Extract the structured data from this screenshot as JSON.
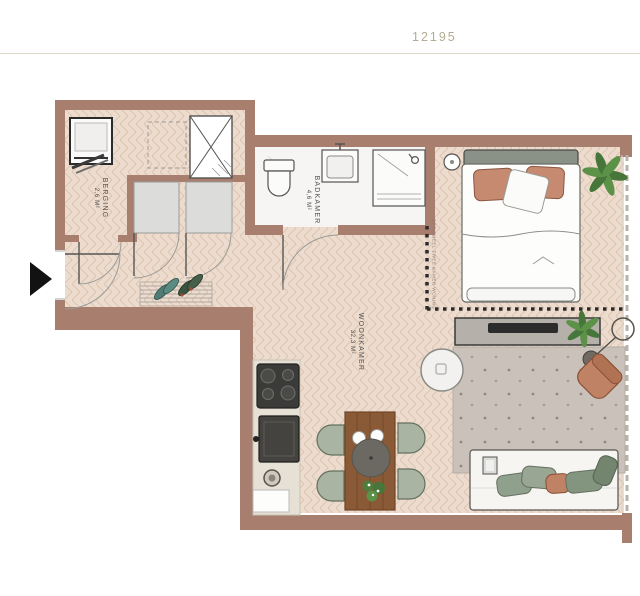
{
  "header": {
    "plan_number": "12195"
  },
  "plan": {
    "rooms": [
      {
        "name": "BERGING",
        "area": "2,6 M²"
      },
      {
        "name": "BADKAMER",
        "area": "4,6 M²"
      },
      {
        "name": "WOONKAMER",
        "area": "32,3 M²"
      }
    ],
    "annotation": {
      "optional_label": "OPTIONEEL TWEE KAMER WONING"
    },
    "colors": {
      "wall": "#a87e6e",
      "floor": "#eddccd",
      "floor_stroke": "#dcc5b2",
      "bathroom_floor": "#f6f5f3",
      "rug": "#cac2ba",
      "accent_terracotta": "#c08264",
      "accent_sage": "#a9b4a3",
      "plant_green": "#4e7d3e",
      "wood": "#8a5a36",
      "header_text": "#b3ab92",
      "label_text": "#4f4f4f",
      "divider": "#ddd7c7"
    },
    "icons": [
      "entrance-arrow-icon",
      "washing-machine-icon",
      "ventilation-shaft-icon",
      "wardrobe-icon",
      "doormat-icon",
      "shoes-icon",
      "toilet-icon",
      "washbasin-icon",
      "shower-icon",
      "double-bed-icon",
      "plant-icon",
      "tv-cabinet-icon",
      "floor-lamp-icon",
      "armchair-icon",
      "coffee-table-icon",
      "rug-icon",
      "sofa-icon",
      "dining-table-icon",
      "dining-chair-icon",
      "cooktop-icon",
      "oven-icon",
      "sink-icon",
      "kitchen-counter-icon",
      "optional-wall-dotted-line"
    ]
  }
}
